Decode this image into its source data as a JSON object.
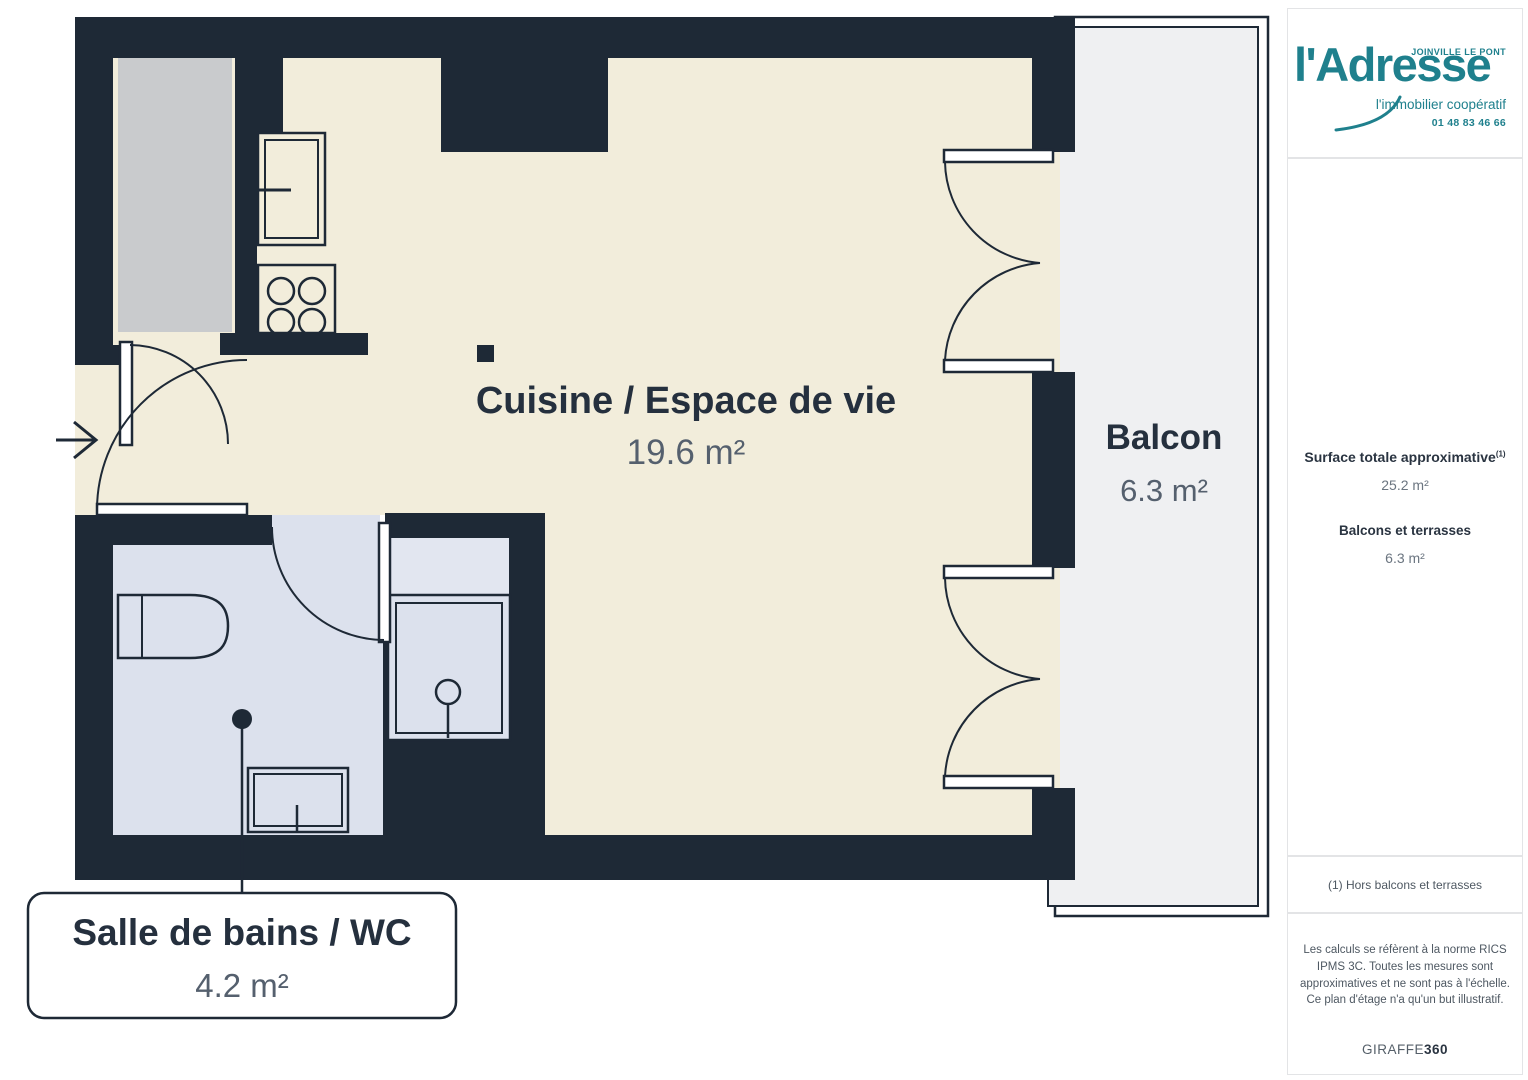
{
  "plan": {
    "rooms": {
      "kitchen": {
        "label": "Cuisine / Espace de vie",
        "area": "19.6 m²"
      },
      "balcony": {
        "label": "Balcon",
        "area": "6.3 m²"
      },
      "bathroom": {
        "label": "Salle de bains / WC",
        "area": "4.2 m²"
      }
    },
    "colors": {
      "wall": "#1E2936",
      "kitchen_floor": "#F2EDDB",
      "bathroom_floor": "#DCE1ED",
      "balcony_floor": "#EFF0F2",
      "closet": "#C9CBCD",
      "label_text": "#25303E",
      "area_text": "#55606E"
    }
  },
  "sidebar": {
    "brand": {
      "location": "JOINVILLE LE PONT",
      "name": "l'Adresse",
      "tagline": "l'immobilier coopératif",
      "phone": "01 48 83 46 66",
      "color": "#1F808D"
    },
    "surface": {
      "total_label": "Surface totale approximative",
      "total_sup": "(1)",
      "total_value": "25.2 m²",
      "balcony_label": "Balcons et terrasses",
      "balcony_value": "6.3 m²"
    },
    "footnote": "(1) Hors balcons et terrasses",
    "disclaimer": "Les calculs se réfèrent à la norme RICS IPMS 3C. Toutes les mesures sont approximatives et ne sont pas à l'échelle. Ce plan d'étage n'a qu'un but illustratif.",
    "watermark": {
      "brand": "GIRAFFE",
      "suffix": "360"
    }
  }
}
